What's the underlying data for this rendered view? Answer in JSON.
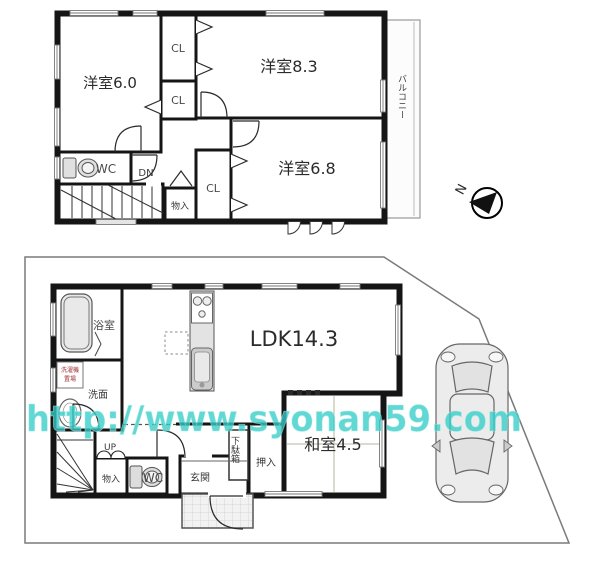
{
  "watermark": {
    "text": "http://www.syonan59.com"
  },
  "compass": {
    "label": "N"
  },
  "floor2": {
    "labels": {
      "room60": "洋室6.0",
      "room83": "洋室8.3",
      "room68": "洋室6.8",
      "cl1": "CL",
      "cl2": "CL",
      "cl3": "CL",
      "wc": "WC",
      "dn": "DN",
      "storage": "物入",
      "balcony": "バルコニー"
    }
  },
  "floor1": {
    "labels": {
      "ldk": "LDK14.3",
      "washitsu": "和室4.5",
      "bath": "浴室",
      "washroom": "洗面",
      "laundry_line1": "洗濯機",
      "laundry_line2": "置場",
      "up": "UP",
      "storage": "物入",
      "wc": "WC",
      "entrance": "玄関",
      "shoe_cabinet": "下駄箱",
      "closet": "押入"
    }
  },
  "colors": {
    "room_cream": "#f6eecb",
    "room_stripe": "#eadfb4",
    "closet_pink": "#e6d3c7",
    "wet_blue": "#d3daee",
    "tatami_green": "#d9dcc1",
    "fixture_gray": "#e9e9e9",
    "wall": "#151515",
    "lot_line": "#7a7a7a",
    "watermark_teal": "#35cdc6"
  }
}
